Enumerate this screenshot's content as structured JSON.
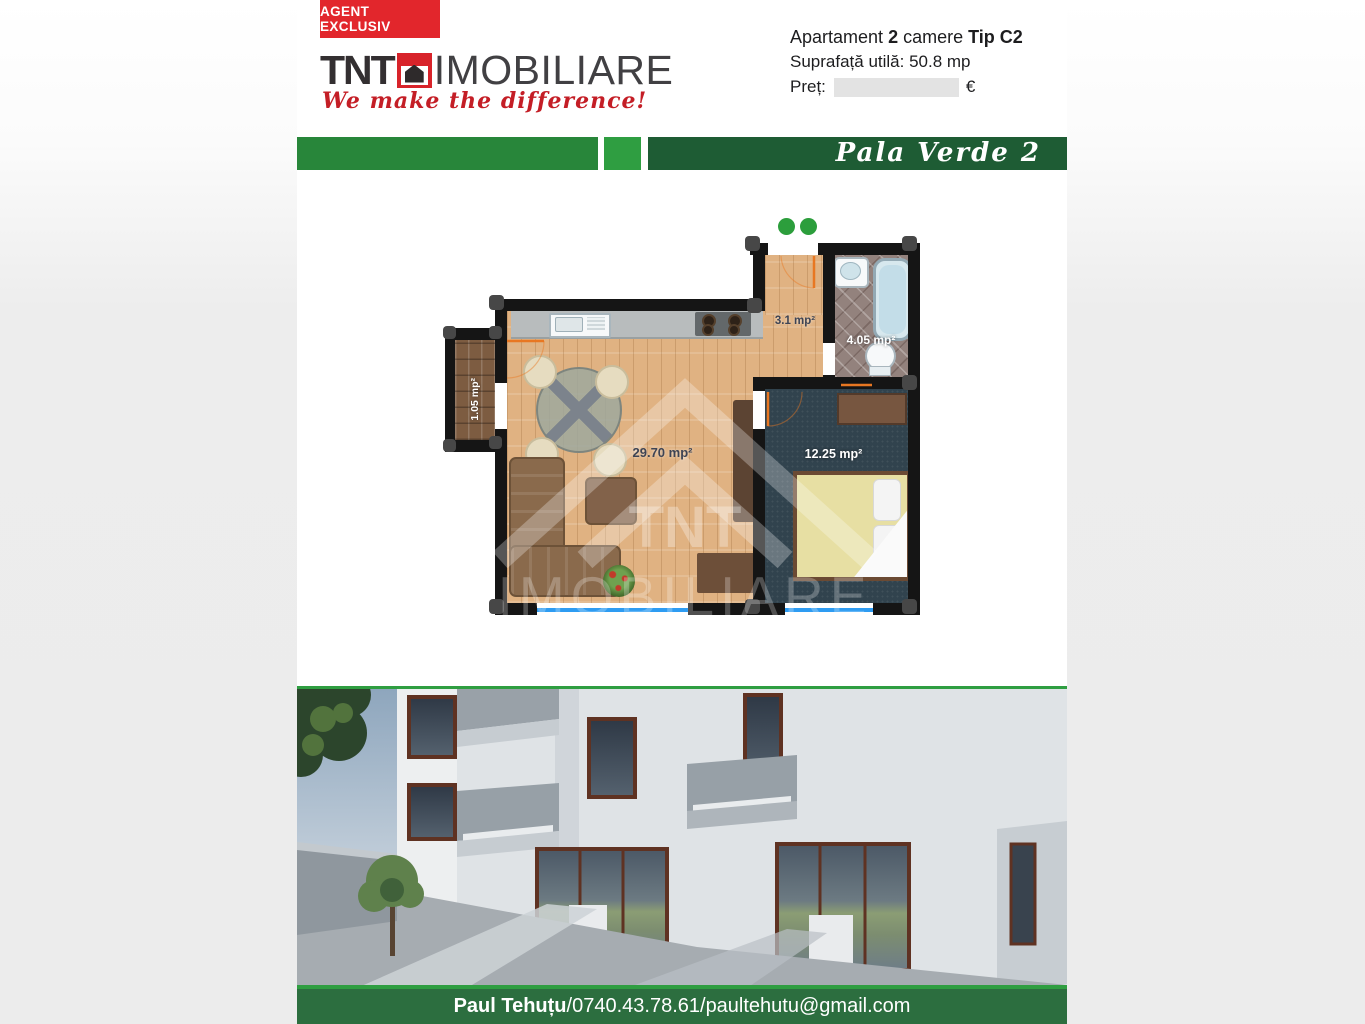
{
  "header": {
    "badge": "AGENT EXCLUSIV",
    "logo": {
      "tnt": "TNT",
      "imobiliare": "IMOBILIARE",
      "tagline": "We make the difference!"
    },
    "info": {
      "l1a": "Apartament ",
      "l1b": "2",
      "l1c": " camere ",
      "l1d": "Tip C2",
      "l2": "Suprafață utilă: 50.8 mp",
      "l3_label": "Preț:",
      "l3_currency": "€"
    }
  },
  "banner": {
    "title": "Pala Verde 2"
  },
  "floorplan": {
    "rooms": [
      {
        "name": "living",
        "area_label": "29.70 mp²"
      },
      {
        "name": "bedroom",
        "area_label": "12.25 mp²"
      },
      {
        "name": "hallway",
        "area_label": "3.1 mp²"
      },
      {
        "name": "bathroom",
        "area_label": "4.05 mp²"
      },
      {
        "name": "balcony",
        "area_label": "1.05 mp²"
      }
    ],
    "watermark": {
      "line1": "TNT",
      "line2": "IMOBILIARE"
    }
  },
  "footer": {
    "name": "Paul Tehuțu",
    "sep1": " / ",
    "phone": "0740.43.78.61",
    "sep2": " / ",
    "email": "paultehutu@gmail.com"
  },
  "colors": {
    "brand_red": "#d8232a",
    "banner_green_left": "#28863a",
    "banner_green_mid": "#2f9e41",
    "banner_green_right": "#1e5c34",
    "footer_green": "#2c6e3f",
    "window_blue": "#2e9cf2"
  }
}
